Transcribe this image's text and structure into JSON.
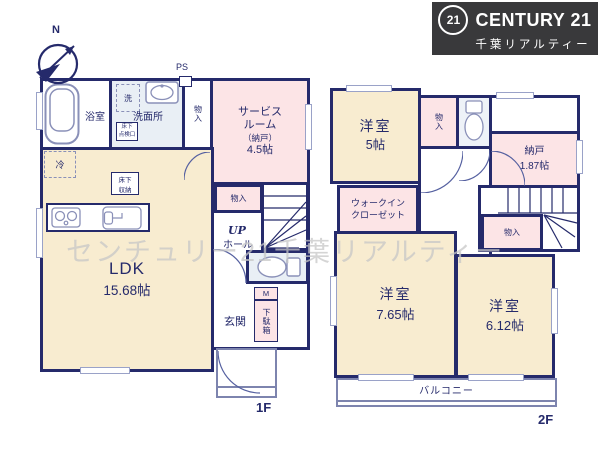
{
  "branding": {
    "badge": "21",
    "name": "CENTURY 21",
    "company": "千葉リアルティー"
  },
  "watermark": "センチュリー21千葉リアルティー",
  "compass": {
    "north": "N"
  },
  "floor1": {
    "label": "1F",
    "bath": "浴室",
    "washroom": "洗面所",
    "laundry": "洗",
    "hatch_l1": "床下",
    "hatch_l2": "点検口",
    "ps": "PS",
    "closet_top": "物入",
    "service_l1": "サービス",
    "service_l2": "ルーム",
    "service_l3": "（納戸）",
    "service_l4": "4.5帖",
    "fridge": "冷",
    "underfloor_l1": "床下",
    "underfloor_l2": "収納",
    "ldk": "LDK",
    "ldk_size": "15.68帖",
    "closet_mid": "物入",
    "up": "UP",
    "hall": "ホール",
    "meter": "M",
    "shoebox": "下駄箱",
    "entrance": "玄関"
  },
  "floor2": {
    "label": "2F",
    "bedroom_a": "洋室",
    "bedroom_a_size": "5帖",
    "closet_top": "物入",
    "storage": "納戸",
    "storage_size": "1.87帖",
    "dn": "DN",
    "closet_stairs": "物入",
    "wic_l1": "ウォークイン",
    "wic_l2": "クローゼット",
    "bedroom_b": "洋室",
    "bedroom_b_size": "7.65帖",
    "bedroom_c": "洋室",
    "bedroom_c_size": "6.12帖",
    "balcony": "バルコニー"
  },
  "colors": {
    "wall": "#252a6b",
    "room_cream": "#f8ecd0",
    "room_pink": "#fce4e6",
    "room_blue": "#e9eff5",
    "logo_bg": "#39393b",
    "watermark_gray": "#c7c7c7"
  }
}
